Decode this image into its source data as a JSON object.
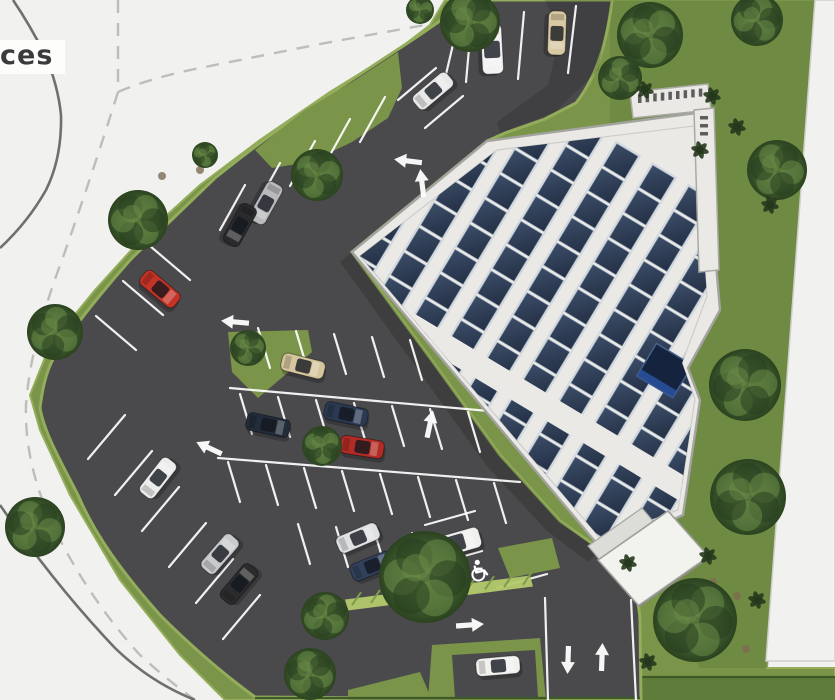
{
  "label": {
    "text": "ces"
  },
  "palette": {
    "road": "#f1f1ef",
    "road_line": "#6f6f6d",
    "road_dash": "#bdbdba",
    "grass": "#7a9449",
    "grass_dark": "#66833e",
    "grass_light": "#93ad5b",
    "hedge": "#5f7c3a",
    "asphalt": "#4a4a4c",
    "line_white": "#ffffff",
    "roof": "#eae9e5",
    "roof_border": "#a3a3a0",
    "panel": "#2e3c51",
    "panel_grid": "#93a5b8",
    "panel_frame": "#cfd6de",
    "skylight": "#16233f",
    "skylight_glow": "#2a55a8",
    "tree": "#3c5a2e",
    "tree_dark": "#26391d",
    "tree_light": "#6d8f4a",
    "mulch": "#7d6b52"
  },
  "solar_array": {
    "angle": 31,
    "strip_columns": 10,
    "cells_per_strip": 15
  },
  "cars": [
    {
      "x": 470,
      "y": 6,
      "angle": 86,
      "color": "#2e2e30",
      "kind": "car"
    },
    {
      "x": 492,
      "y": 49,
      "angle": 87,
      "color": "#f2f2f2",
      "kind": "van"
    },
    {
      "x": 557,
      "y": 33,
      "angle": 92,
      "color": "#d8c9a3",
      "kind": "car"
    },
    {
      "x": 433,
      "y": 91,
      "angle": -40,
      "color": "#e8e8e8",
      "kind": "car"
    },
    {
      "x": 266,
      "y": 203,
      "angle": 119,
      "color": "#b9babc",
      "kind": "car"
    },
    {
      "x": 240,
      "y": 225,
      "angle": 119,
      "color": "#2a2a2c",
      "kind": "car"
    },
    {
      "x": 160,
      "y": 289,
      "angle": 40,
      "color": "#c33327",
      "kind": "car"
    },
    {
      "x": 303,
      "y": 366,
      "angle": 14,
      "color": "#d6c69e",
      "kind": "car"
    },
    {
      "x": 268,
      "y": 425,
      "angle": 12,
      "color": "#232c3a",
      "kind": "car"
    },
    {
      "x": 346,
      "y": 414,
      "angle": 12,
      "color": "#2b3a52",
      "kind": "car"
    },
    {
      "x": 362,
      "y": 447,
      "angle": 9,
      "color": "#b32b25",
      "kind": "car"
    },
    {
      "x": 158,
      "y": 478,
      "angle": -52,
      "color": "#ececec",
      "kind": "car"
    },
    {
      "x": 220,
      "y": 554,
      "angle": -49,
      "color": "#c9cacc",
      "kind": "car"
    },
    {
      "x": 239,
      "y": 584,
      "angle": -50,
      "color": "#2c2c2e",
      "kind": "car"
    },
    {
      "x": 358,
      "y": 538,
      "angle": -23,
      "color": "#dfe1e2",
      "kind": "car"
    },
    {
      "x": 372,
      "y": 566,
      "angle": -22,
      "color": "#31415c",
      "kind": "car"
    },
    {
      "x": 456,
      "y": 543,
      "angle": -16,
      "color": "#f0f0ef",
      "kind": "van"
    },
    {
      "x": 498,
      "y": 666,
      "angle": -5,
      "color": "#f1f1f0",
      "kind": "car"
    }
  ],
  "trees": [
    {
      "x": 470,
      "y": 22,
      "r": 30
    },
    {
      "x": 420,
      "y": 10,
      "r": 14
    },
    {
      "x": 650,
      "y": 35,
      "r": 33
    },
    {
      "x": 757,
      "y": 20,
      "r": 26
    },
    {
      "x": 620,
      "y": 78,
      "r": 22
    },
    {
      "x": 777,
      "y": 170,
      "r": 30
    },
    {
      "x": 317,
      "y": 175,
      "r": 26
    },
    {
      "x": 205,
      "y": 155,
      "r": 13
    },
    {
      "x": 138,
      "y": 220,
      "r": 30
    },
    {
      "x": 55,
      "y": 332,
      "r": 28
    },
    {
      "x": 35,
      "y": 527,
      "r": 30
    },
    {
      "x": 248,
      "y": 348,
      "r": 18
    },
    {
      "x": 322,
      "y": 446,
      "r": 20
    },
    {
      "x": 425,
      "y": 577,
      "r": 46
    },
    {
      "x": 325,
      "y": 616,
      "r": 24
    },
    {
      "x": 310,
      "y": 674,
      "r": 26
    },
    {
      "x": 745,
      "y": 385,
      "r": 36
    },
    {
      "x": 748,
      "y": 497,
      "r": 38
    },
    {
      "x": 695,
      "y": 620,
      "r": 42
    }
  ],
  "shrubs": [
    {
      "x": 645,
      "y": 90
    },
    {
      "x": 712,
      "y": 96
    },
    {
      "x": 737,
      "y": 127
    },
    {
      "x": 700,
      "y": 150
    },
    {
      "x": 770,
      "y": 205
    },
    {
      "x": 628,
      "y": 563
    },
    {
      "x": 708,
      "y": 556
    },
    {
      "x": 648,
      "y": 662
    },
    {
      "x": 757,
      "y": 600
    }
  ],
  "mulch": [
    {
      "x": 162,
      "y": 176
    },
    {
      "x": 200,
      "y": 170
    },
    {
      "x": 118,
      "y": 207
    },
    {
      "x": 737,
      "y": 596
    },
    {
      "x": 746,
      "y": 649
    },
    {
      "x": 713,
      "y": 582
    }
  ],
  "arrows": [
    {
      "x": 408,
      "y": 161,
      "rot": 187
    },
    {
      "x": 422,
      "y": 183,
      "rot": -97
    },
    {
      "x": 235,
      "y": 322,
      "rot": 185
    },
    {
      "x": 209,
      "y": 448,
      "rot": 205
    },
    {
      "x": 430,
      "y": 424,
      "rot": -78
    },
    {
      "x": 470,
      "y": 625,
      "rot": -4
    },
    {
      "x": 568,
      "y": 660,
      "rot": 92
    },
    {
      "x": 602,
      "y": 657,
      "rot": -88
    }
  ],
  "accessible_marking": {
    "x": 478,
    "y": 571,
    "rot": -15
  },
  "hatch_strip": {
    "x1": 345,
    "y1": 600,
    "x2": 530,
    "y2": 578,
    "width": 13
  }
}
